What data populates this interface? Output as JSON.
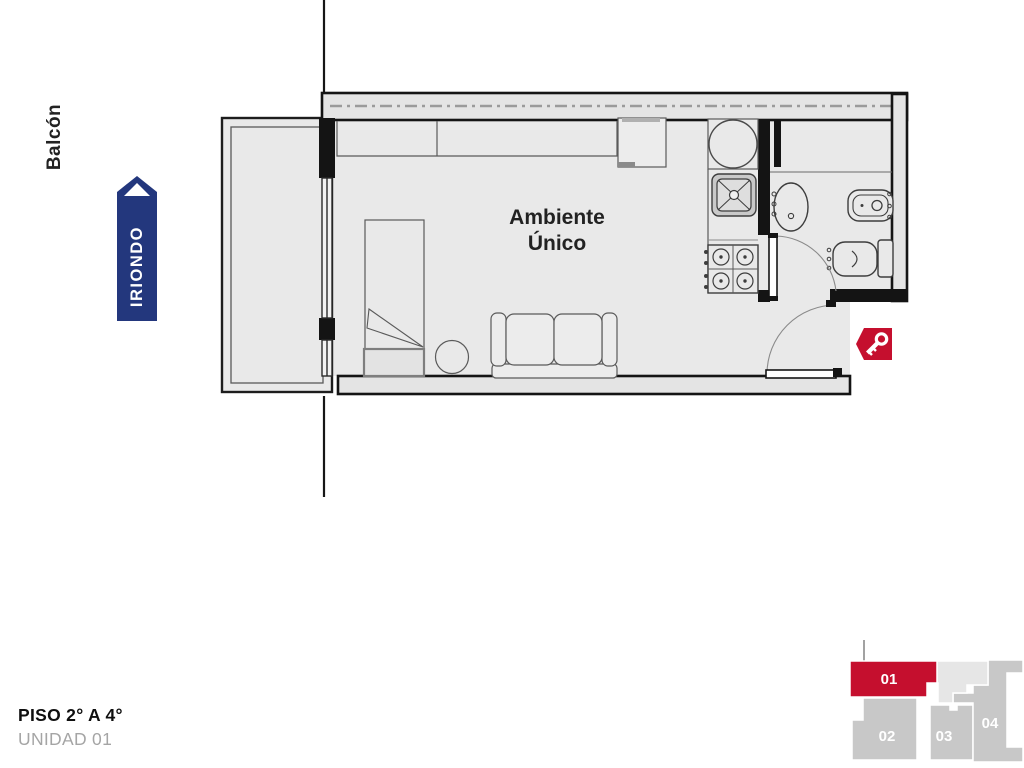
{
  "plan": {
    "street_label": "IRIONDO",
    "main_room_label": "Ambiente Único",
    "balcony_label": "Balcón",
    "fixtures": [
      "washing-machine",
      "kitchen-sink",
      "stove",
      "bathroom-sink",
      "bidet",
      "toilet",
      "bed",
      "sofa",
      "side-table",
      "desk",
      "closet"
    ],
    "doors": [
      "bathroom-door",
      "entry-door"
    ]
  },
  "footer": {
    "floor_title": "PISO 2° A 4°",
    "unit_subtitle": "UNIDAD 01"
  },
  "minimap": {
    "units": [
      {
        "label": "01",
        "highlighted": true
      },
      {
        "label": "02",
        "highlighted": false
      },
      {
        "label": "03",
        "highlighted": false
      },
      {
        "label": "04",
        "highlighted": false
      }
    ]
  },
  "colors": {
    "accent_blue": "#23377d",
    "accent_red": "#c50f2e",
    "floor_gray": "#e9e9e9",
    "wall_fill": "#e4e4e4",
    "minimap_gray": "#c8c8c8",
    "minimap_light": "#e6e6e6"
  }
}
